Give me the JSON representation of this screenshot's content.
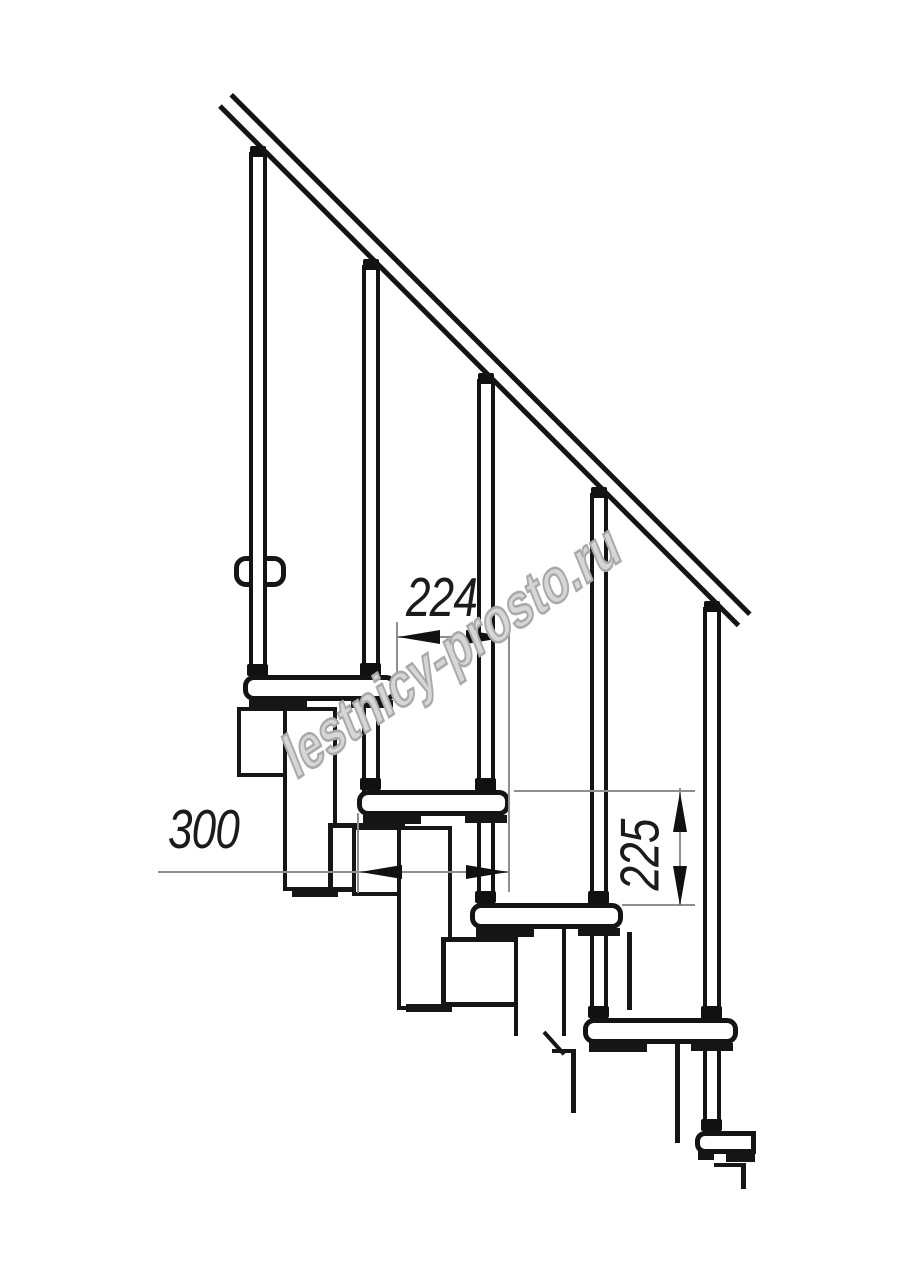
{
  "drawing": {
    "type": "staircase-side-view-technical-drawing",
    "watermark": "lestnicy-prosto.ru",
    "dimensions": {
      "going": "224",
      "tread_depth": "300",
      "riser_height": "225"
    },
    "counts": {
      "balusters": 5,
      "treads_visible": 5
    },
    "colors": {
      "object_line": "#161616",
      "dimension_line": "#8f8f8f",
      "dimension_text": "#1b1b1b",
      "watermark_outline": "#a9a9a9",
      "background": "#ffffff"
    }
  }
}
